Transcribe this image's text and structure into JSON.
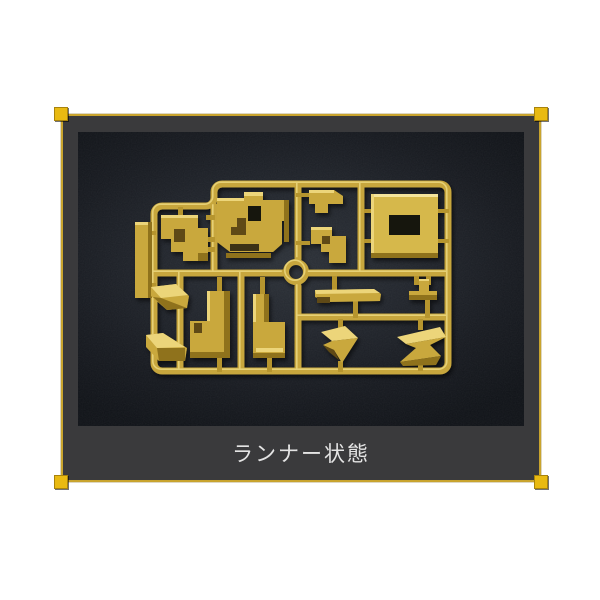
{
  "page": {
    "background": "#ffffff"
  },
  "panel": {
    "background": "#3a3a3c",
    "border_color": "#c9a42e",
    "corner_marker_color": "#e9ba12"
  },
  "photo": {
    "description": "gold-colored plastic model-kit runner sprue with attached parts, photographed on a dark leather-textured surface",
    "background_center": "#2c3138",
    "background_edge": "#101318",
    "sprue_color": "#c7a63c",
    "sprue_highlight": "#ecd87e",
    "sprue_shadow": "#8f721f",
    "part_plate_color": "#d6b84c"
  },
  "caption": {
    "label": "ランナー状態",
    "text_color": "#e4e4e4"
  }
}
